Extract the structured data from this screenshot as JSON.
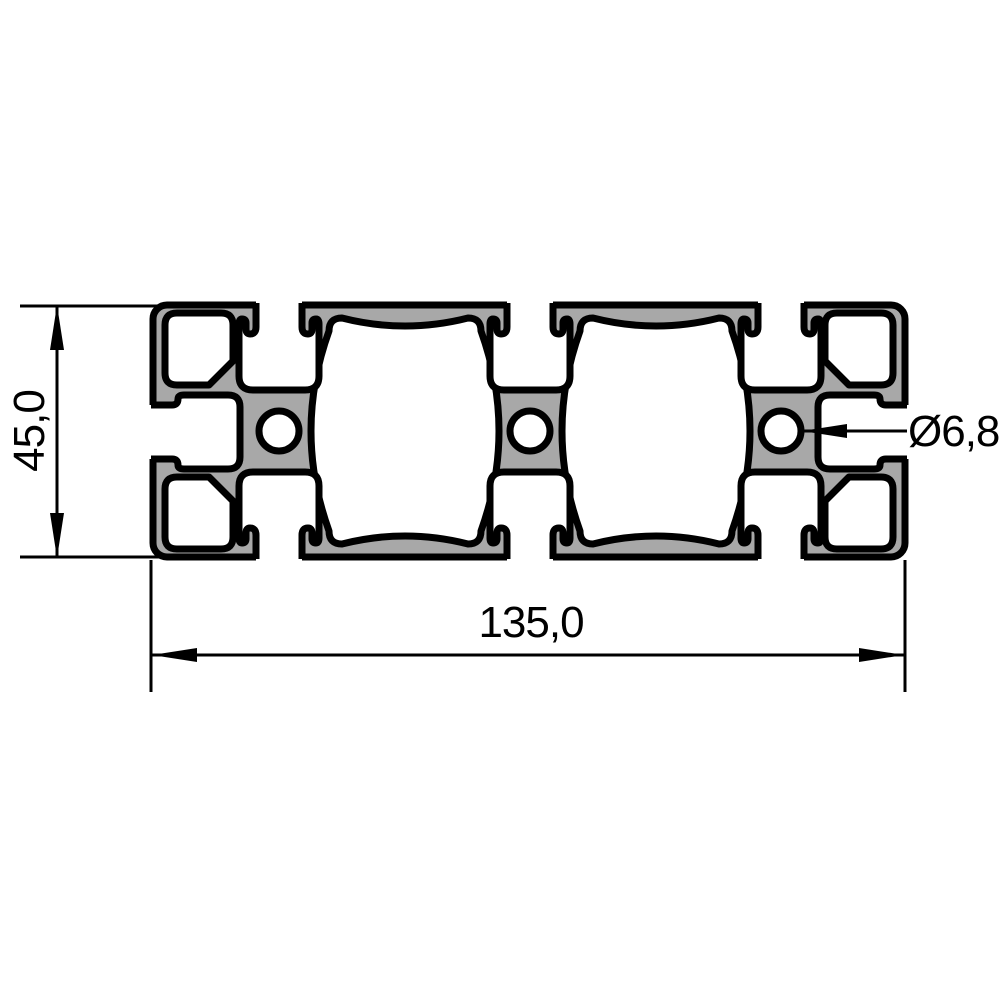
{
  "drawing": {
    "type_note": "profile cross-section technical drawing",
    "labels": {
      "height": "45,0",
      "width": "135,0",
      "hole_diameter": "Ø6,8"
    },
    "colors": {
      "profile_fill": "#A8A8A8",
      "line": "#000000",
      "background": "#FFFFFF"
    }
  }
}
